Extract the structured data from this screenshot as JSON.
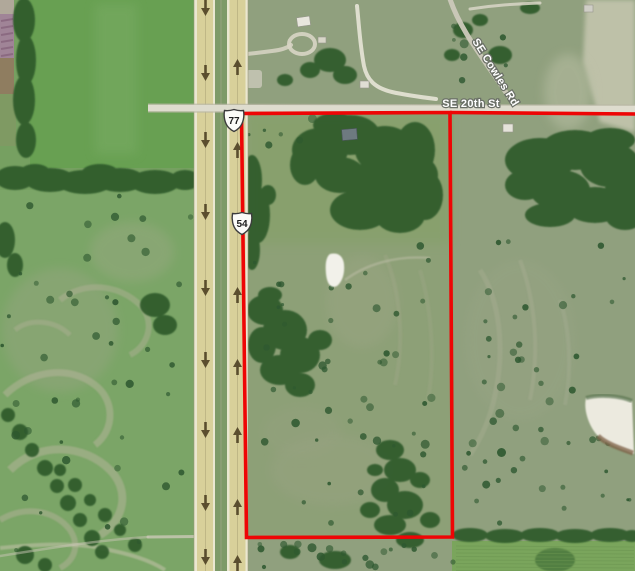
{
  "map": {
    "type": "aerial-satellite-view",
    "parcel_boundary": {
      "color": "#ee0505",
      "shape": "red outlined parcel east of divided highway"
    },
    "highway": {
      "shields": [
        {
          "route": "77"
        },
        {
          "route": "54"
        }
      ],
      "northbound_arrows": "up",
      "southbound_arrows": "down"
    },
    "road_labels": [
      {
        "name": "SE 20th St"
      },
      {
        "name": "SE Cowles Rd"
      }
    ],
    "palette": {
      "field_green": "#68a052",
      "pasture_green": "#7ba567",
      "gray_pasture": "#90a07e",
      "tree_green": "#2f5a2c",
      "pavement_tan": "#d8d09a",
      "minor_road_gray": "#d6d4c6",
      "boundary_red": "#ee0505"
    }
  }
}
